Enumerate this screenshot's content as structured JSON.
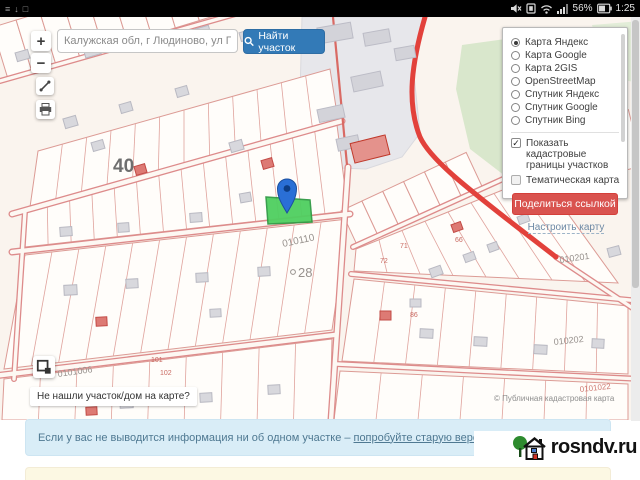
{
  "status_bar": {
    "time": "1:25",
    "battery_percent": "56%",
    "left_icons": [
      "sync-icon",
      "download-icon",
      "screenshot-icon"
    ],
    "right_icons": [
      "mute-icon",
      "sim-icon",
      "wifi-icon",
      "signal-icon",
      "battery-icon"
    ]
  },
  "search": {
    "value": "Калужская обл, г Людиново, ул Песочн",
    "button_label": "Найти участок"
  },
  "zoom_controls": {
    "zoom_in": "+",
    "zoom_out": "−"
  },
  "layers_panel": {
    "base_layers": [
      {
        "label": "Карта Яндекс",
        "selected": true
      },
      {
        "label": "Карта Google",
        "selected": false
      },
      {
        "label": "Карта 2GIS",
        "selected": false
      },
      {
        "label": "OpenStreetMap",
        "selected": false
      },
      {
        "label": "Спутник Яндекс",
        "selected": false
      },
      {
        "label": "Спутник Google",
        "selected": false
      },
      {
        "label": "Спутник Bing",
        "selected": false
      }
    ],
    "overlays": [
      {
        "label": "Показать кадастровые границы участков",
        "checked": true
      },
      {
        "label": "Тематическая карта",
        "checked": false
      }
    ],
    "share_button_label": "Поделиться ссылкой",
    "configure_link_label": "Настроить карту",
    "accent_color": "#d9534f"
  },
  "map": {
    "labels": {
      "quarter_number": "40",
      "center_quarter_code": "010110",
      "parcel_28": "28",
      "bottom_left_code": "0101006",
      "right_code_upper": "010201",
      "right_code_lower": "010202",
      "far_right_code": "0101022"
    },
    "parcel_numbers": [
      "101",
      "102",
      "71",
      "72",
      "86",
      "66"
    ],
    "attribution": "© Публичная кадастровая карта",
    "not_found_label": "Не нашли участок/дом на карте?",
    "selected_parcel_color": "#4fcf60",
    "pin_color": "#2a6fd6"
  },
  "alerts": {
    "info_text": "Если у вас не выводится информация ни об одном участке –",
    "info_link_label": "попробуйте старую версию карты →"
  },
  "branding": {
    "logo_text": "rosndv.ru"
  }
}
